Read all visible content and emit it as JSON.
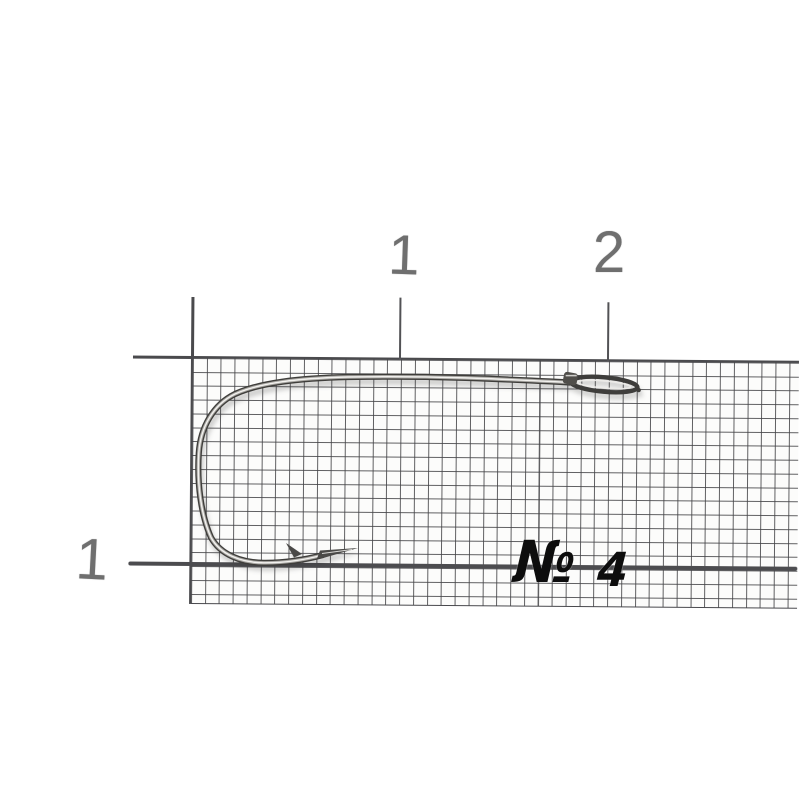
{
  "scene": {
    "description": "Fishing hook size No.4 photographed on millimeter graph paper",
    "background_color": "#ffffff",
    "paper_grid_color": "#46464a",
    "ruler_mark_color": "#4a4a4d"
  },
  "ruler": {
    "top_labels": [
      {
        "text": "1"
      },
      {
        "text": "2"
      }
    ],
    "side_labels": [
      {
        "text": "1"
      }
    ],
    "label_color": "#6f6f6f"
  },
  "annotation": {
    "numero_sign": "№",
    "size_value": "4",
    "color": "#0d0d0d"
  },
  "hook": {
    "kind": "fishing-hook",
    "metal_dark": "#3f3e3b",
    "metal_mid": "#a9a7a3",
    "metal_highlight": "#f3f2ef"
  }
}
